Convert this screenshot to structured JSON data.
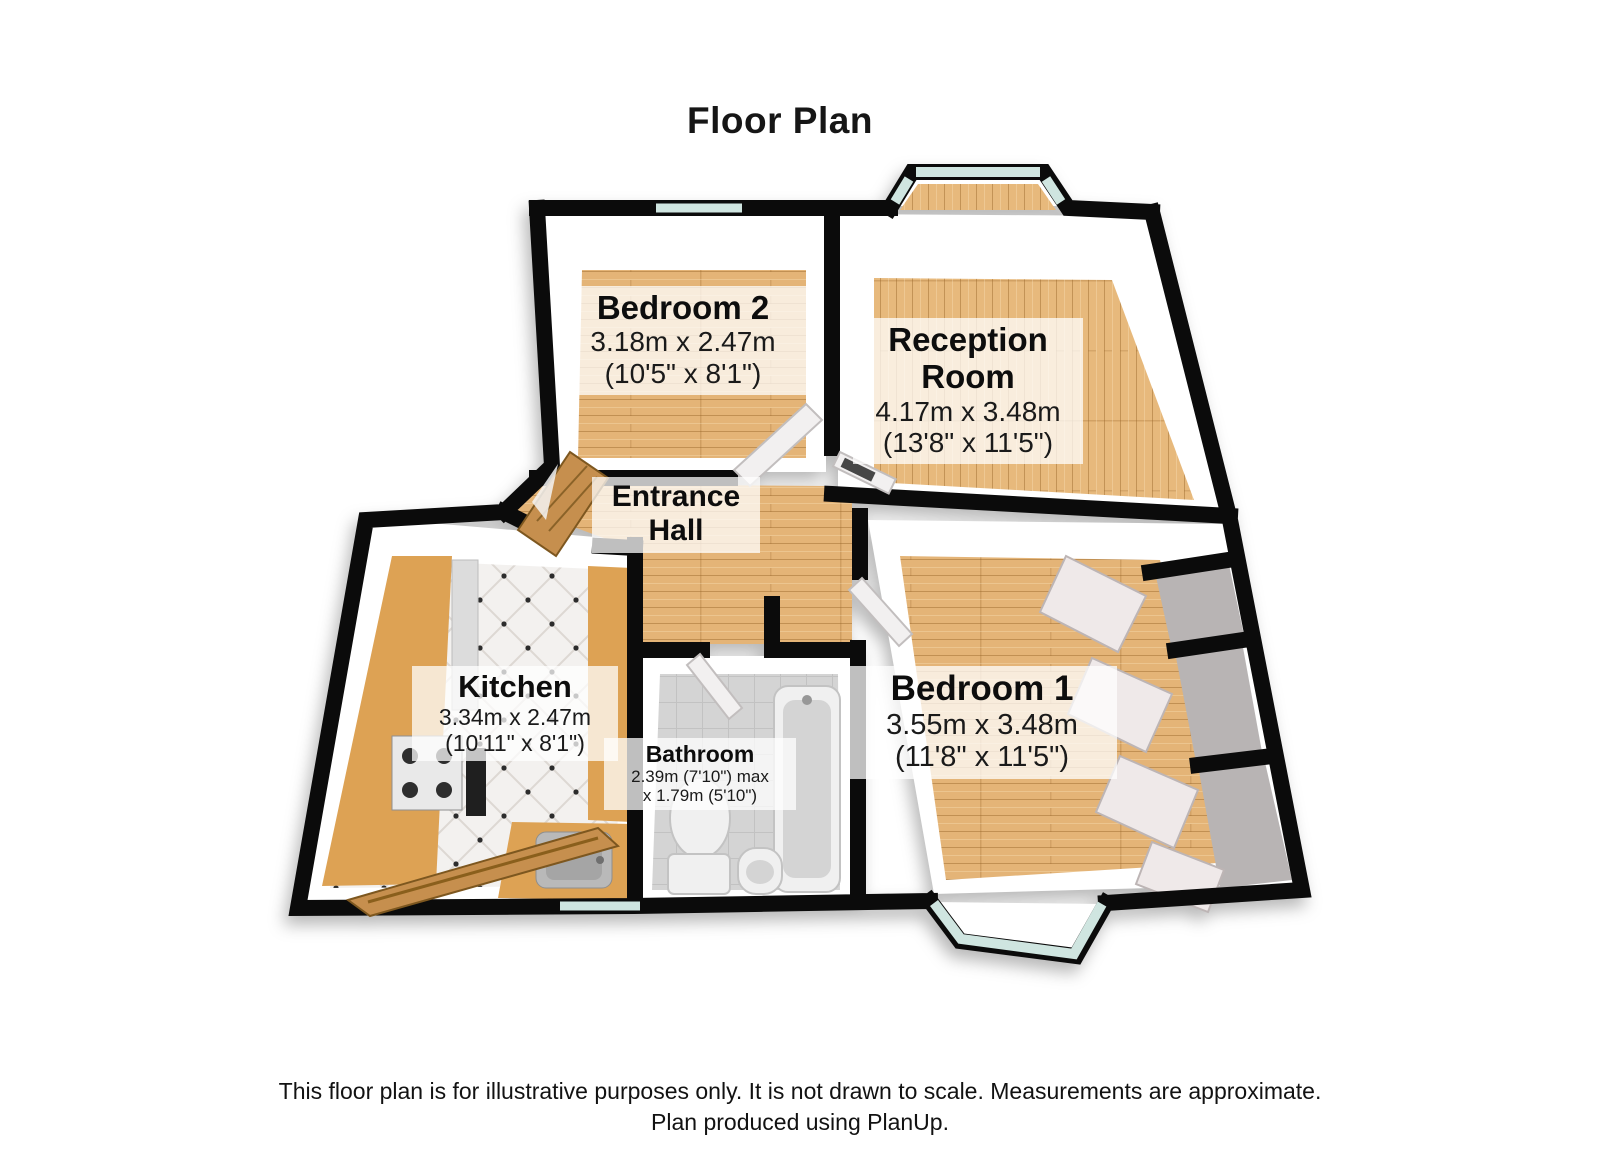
{
  "title": "Floor Plan",
  "rooms": {
    "bedroom2": {
      "name": "Bedroom 2",
      "dim_metric": "3.18m x 2.47m",
      "dim_imperial": "(10'5\" x 8'1\")"
    },
    "reception": {
      "name": "Reception Room",
      "dim_metric": "4.17m x 3.48m",
      "dim_imperial": "(13'8\" x 11'5\")"
    },
    "entrance_hall": {
      "name": "Entrance Hall"
    },
    "kitchen": {
      "name": "Kitchen",
      "dim_metric": "3.34m x 2.47m",
      "dim_imperial": "(10'11\" x 8'1\")"
    },
    "bathroom": {
      "name": "Bathroom",
      "dim_line1": "2.39m (7'10\") max",
      "dim_line2": "x 1.79m (5'10\")"
    },
    "bedroom1": {
      "name": "Bedroom 1",
      "dim_metric": "3.55m x 3.48m",
      "dim_imperial": "(11'8\" x 11'5\")"
    }
  },
  "footer": {
    "line1": "This floor plan is for illustrative purposes only. It is not drawn to scale. Measurements are approximate.",
    "line2": "Plan produced using PlanUp."
  },
  "colors": {
    "wall": "#0b0b0b",
    "wood_floor": "#e4b477",
    "kitchen_tile": "#f3f1ef",
    "bath_tile": "#d4d4d4",
    "glass": "#cfe5e0",
    "label_bg": "rgba(255,255,255,0.74)"
  }
}
